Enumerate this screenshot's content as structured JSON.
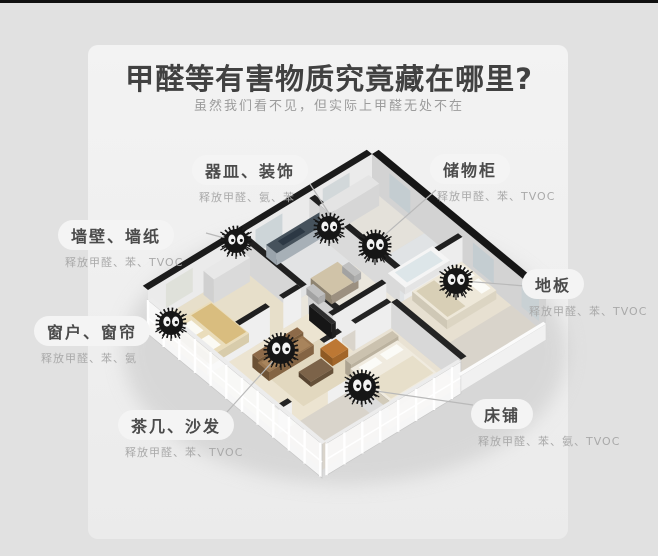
{
  "header": {
    "title": "甲醛等有害物质究竟藏在哪里?",
    "subtitle": "虽然我们看不见，但实际上甲醛无处不在"
  },
  "callouts": [
    {
      "key": "vessels",
      "name": "器皿、装饰",
      "detail": "释放甲醛、氨、苯"
    },
    {
      "key": "cabinet",
      "name": "储物柜",
      "detail": "释放甲醛、苯、TVOC"
    },
    {
      "key": "wallpaper",
      "name": "墙壁、墙纸",
      "detail": "释放甲醛、苯、TVOC"
    },
    {
      "key": "floor",
      "name": "地板",
      "detail": "释放甲醛、苯、TVOC"
    },
    {
      "key": "window",
      "name": "窗户、窗帘",
      "detail": "释放甲醛、苯、氨"
    },
    {
      "key": "sofa",
      "name": "茶几、沙发",
      "detail": "释放甲醛、苯、TVOC"
    },
    {
      "key": "bed",
      "name": "床铺",
      "detail": "释放甲醛、苯、氨、TVOC"
    }
  ],
  "illustration": {
    "type": "3d-apartment-cutaway",
    "sprite_icon": "fuzzy-formaldehyde-monster",
    "sprite_count": 7
  },
  "colors": {
    "page_bg": "#e1e1e1",
    "card_bg": "#efefef",
    "top_border": "#101010",
    "title_text": "#414141",
    "subtitle_text": "#9c9c9c",
    "pill_bg": "#f4f4f4",
    "pill_text": "#4b4b4b",
    "detail_text": "#a9a9a9",
    "wall_cap": "#1b1b1b",
    "sprite": "#161616"
  }
}
